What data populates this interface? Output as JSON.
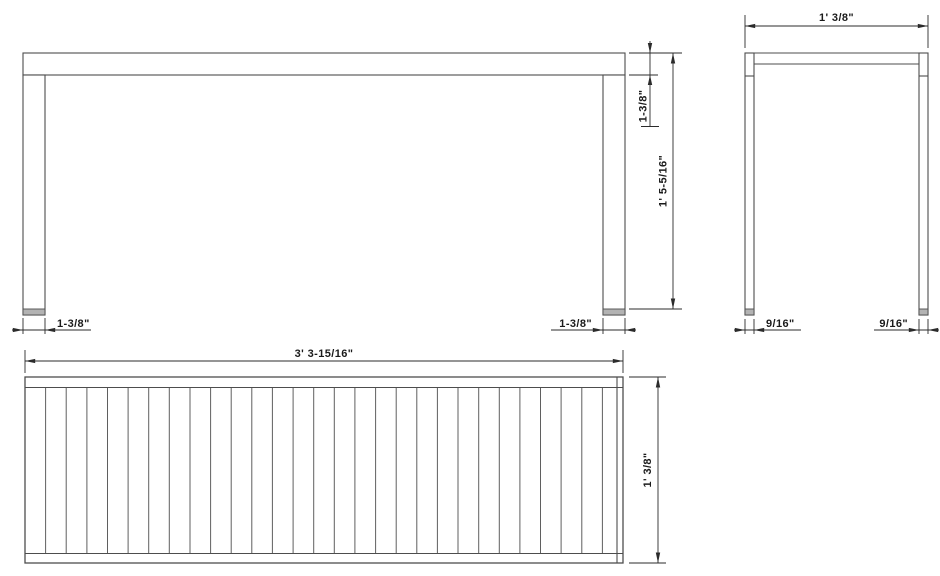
{
  "drawing": {
    "title": "bench-three-view-dimension-drawing",
    "views": {
      "front": {
        "dims": {
          "top_thickness": "1-3/8\"",
          "overall_height": "1' 5-5/16\"",
          "left_leg_width": "1-3/8\"",
          "right_leg_width": "1-3/8\""
        }
      },
      "side": {
        "dims": {
          "overall_width": "1' 3/8\"",
          "left_leg_depth": "9/16\"",
          "right_leg_depth": "9/16\""
        }
      },
      "top": {
        "dims": {
          "overall_length": "3' 3-15/16\"",
          "overall_depth": "1' 3/8\""
        },
        "slat_count": 29,
        "field": {
          "x1": 25,
          "x2": 623,
          "y1": 388,
          "y2": 553
        }
      }
    },
    "colors": {
      "line": "#4d4d4d",
      "dim_line": "#2b2b2b",
      "text": "#1a1a1a",
      "foot_glide": "#b3b3b3",
      "background": "#ffffff"
    }
  }
}
